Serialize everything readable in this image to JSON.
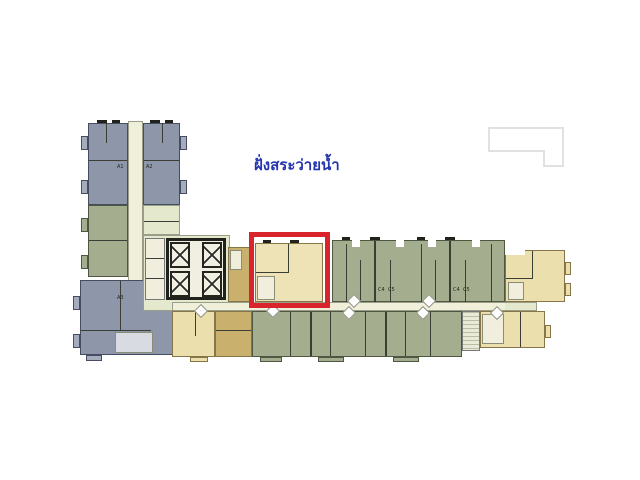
{
  "annotation": {
    "pool_side_label": "ฝั่งสระว่ายน้ำ",
    "pool_side_color": "#2334ae",
    "highlight_color": "#d8242a"
  },
  "palette": {
    "background": "#ffffff",
    "unit_bluegray": "#8e96aa",
    "unit_bluegray_light": "#a5acbd",
    "unit_green": "#a4ae8f",
    "area_green_light": "#e4e9cd",
    "unit_yellow": "#ebdfae",
    "unit_yellow_pale": "#eee3b6",
    "unit_tan": "#c9b06c",
    "corridor_cream": "#f0f0da",
    "core_fill": "#f1efe2",
    "stair_fill": "#e9ebd8",
    "bath_fill": "#f2eedd",
    "keyplan_gray": "#e1e1e1",
    "wall_dark": "#3a3e35"
  },
  "unit_labels": {
    "a1": "A1",
    "a2": "A2",
    "a3": "A3",
    "c4_left": "C4",
    "c5_left": "C5",
    "c4_right": "C4",
    "c5_right": "C5"
  }
}
